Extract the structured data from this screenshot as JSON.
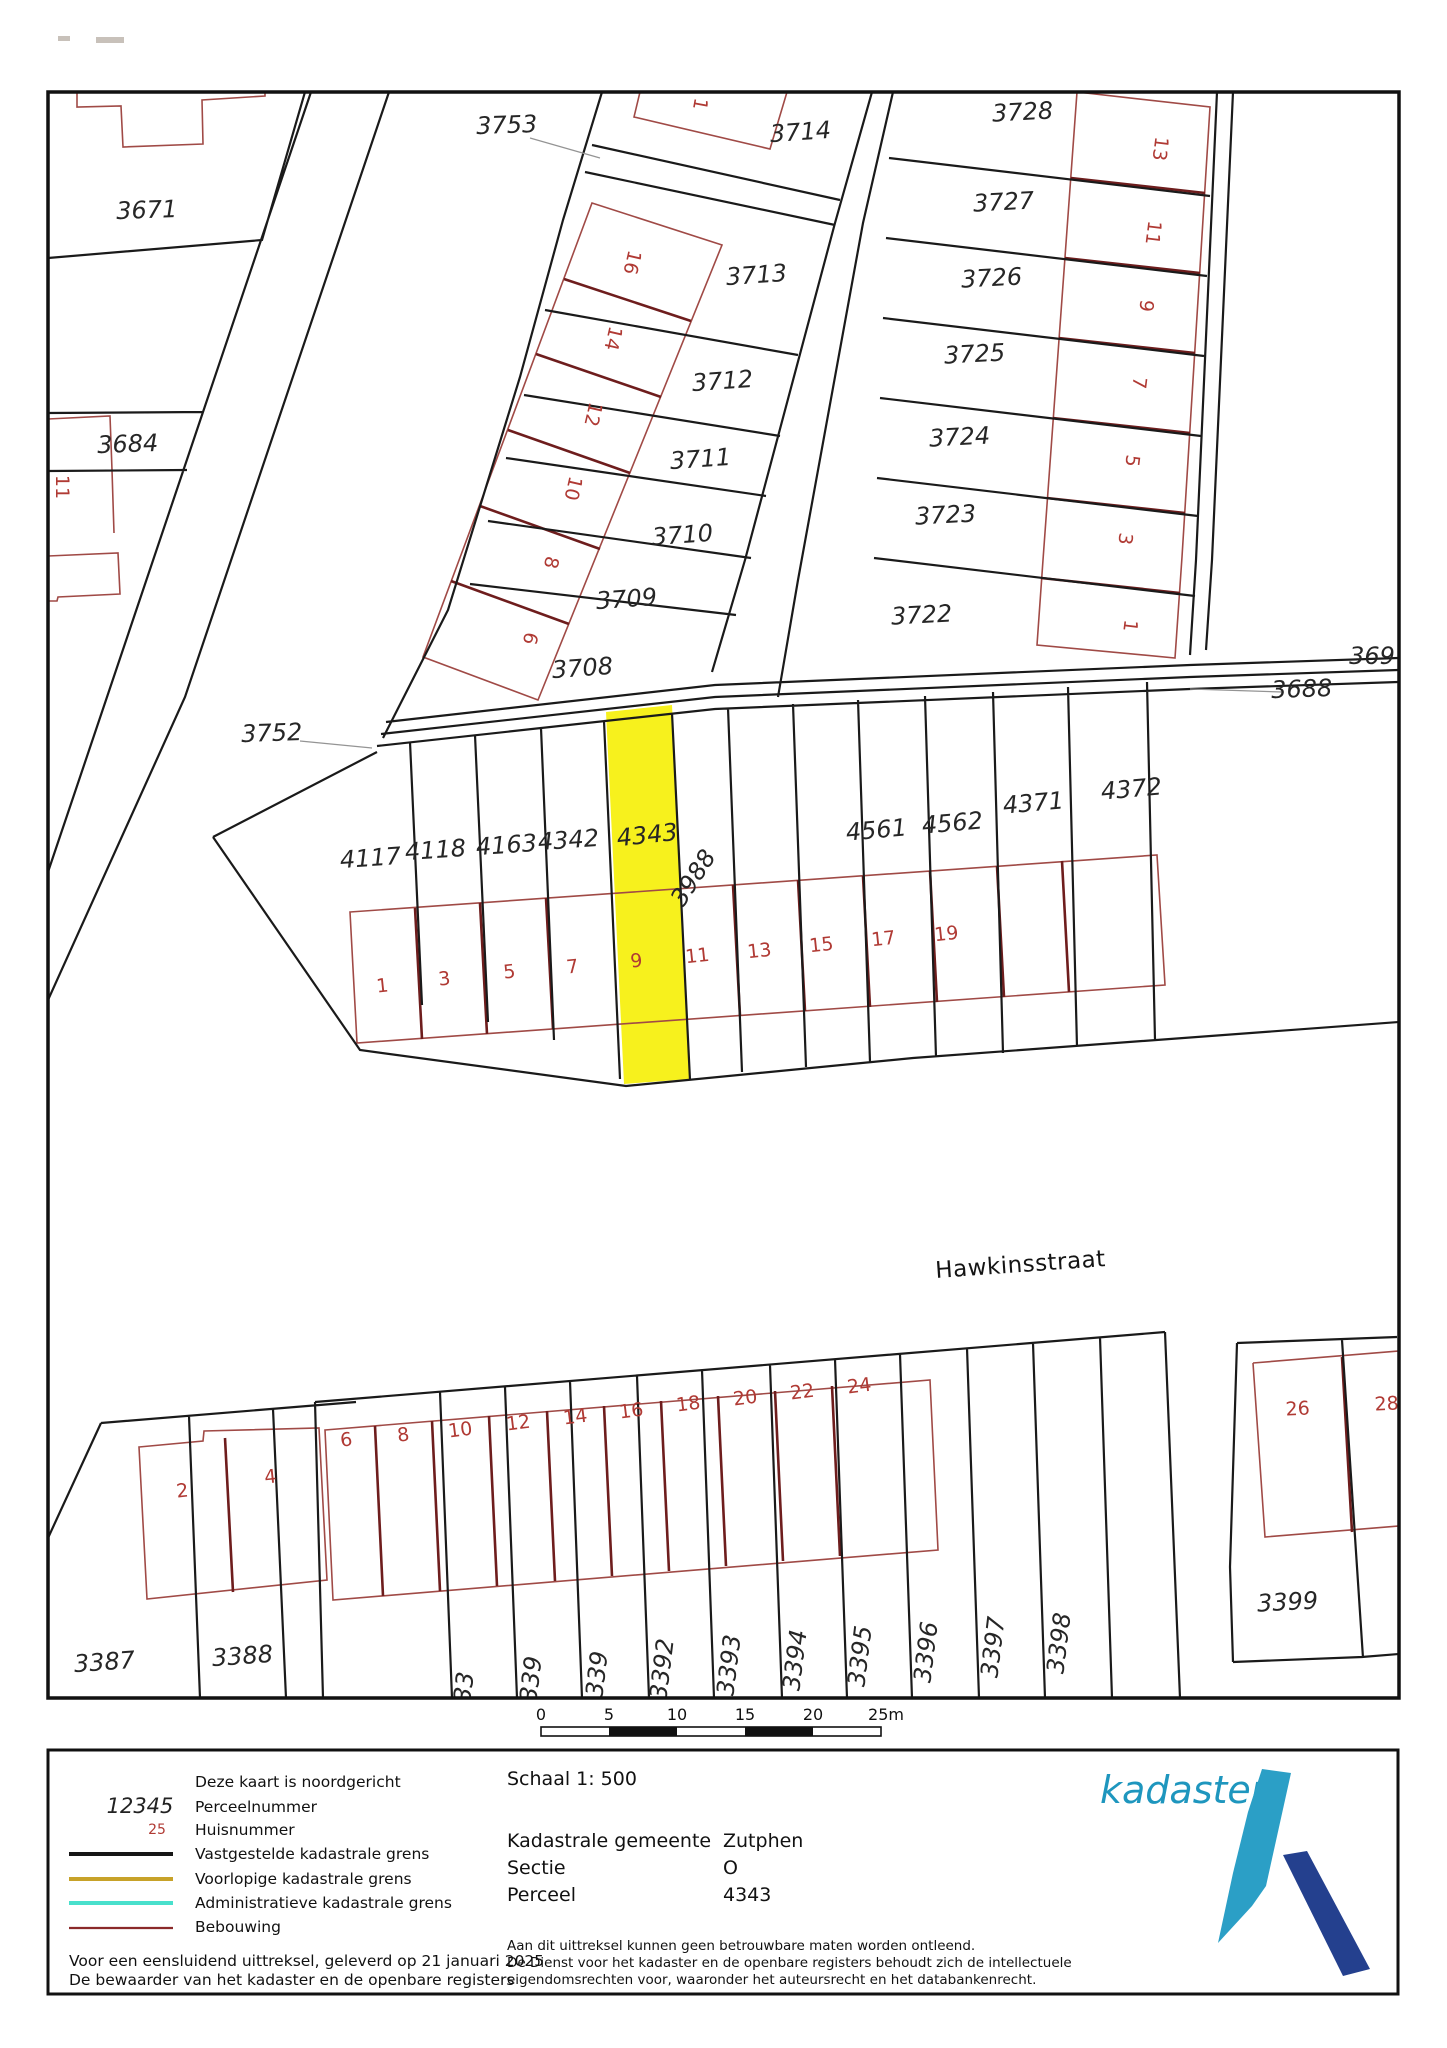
{
  "map": {
    "street_name": "Hawkinsstraat",
    "highlighted_parcel": "4343",
    "colors": {
      "highlight": "#f7f11d",
      "boundary": "#1a1a1a",
      "building": "#a04a46",
      "building_wall": "#6e1d1d",
      "house_number": "#b03a34",
      "leader": "#949494"
    },
    "parcel_labels": [
      {
        "text": "3671",
        "x": 147,
        "y": 218,
        "rot": -2
      },
      {
        "text": "3684",
        "x": 128,
        "y": 452,
        "rot": -2
      },
      {
        "text": "3753",
        "x": 507,
        "y": 133,
        "rot": -2
      },
      {
        "text": "3752",
        "x": 272,
        "y": 741,
        "rot": -2
      },
      {
        "text": "3714",
        "x": 801,
        "y": 140,
        "rot": -4
      },
      {
        "text": "3713",
        "x": 757,
        "y": 283,
        "rot": -4
      },
      {
        "text": "3712",
        "x": 723,
        "y": 389,
        "rot": -4
      },
      {
        "text": "3711",
        "x": 701,
        "y": 467,
        "rot": -4
      },
      {
        "text": "3710",
        "x": 683,
        "y": 543,
        "rot": -4
      },
      {
        "text": "3709",
        "x": 627,
        "y": 607,
        "rot": -4
      },
      {
        "text": "3708",
        "x": 583,
        "y": 676,
        "rot": -4
      },
      {
        "text": "3728",
        "x": 1023,
        "y": 120,
        "rot": -3
      },
      {
        "text": "3727",
        "x": 1004,
        "y": 210,
        "rot": -3
      },
      {
        "text": "3726",
        "x": 992,
        "y": 286,
        "rot": -3
      },
      {
        "text": "3725",
        "x": 975,
        "y": 362,
        "rot": -3
      },
      {
        "text": "3724",
        "x": 960,
        "y": 445,
        "rot": -3
      },
      {
        "text": "3723",
        "x": 946,
        "y": 523,
        "rot": -3
      },
      {
        "text": "3722",
        "x": 922,
        "y": 623,
        "rot": -3
      },
      {
        "text": "3688",
        "x": 1302,
        "y": 697,
        "rot": -2
      },
      {
        "text": "369",
        "x": 1372,
        "y": 664,
        "rot": 0
      },
      {
        "text": "4117",
        "x": 371,
        "y": 866,
        "rot": -4
      },
      {
        "text": "4118",
        "x": 436,
        "y": 858,
        "rot": -4
      },
      {
        "text": "4163",
        "x": 507,
        "y": 853,
        "rot": -4
      },
      {
        "text": "4342",
        "x": 569,
        "y": 848,
        "rot": -4
      },
      {
        "text": "4343",
        "x": 648,
        "y": 843,
        "rot": -6
      },
      {
        "text": "3988",
        "x": 700,
        "y": 882,
        "rot": -57
      },
      {
        "text": "4561",
        "x": 877,
        "y": 838,
        "rot": -5
      },
      {
        "text": "4562",
        "x": 953,
        "y": 831,
        "rot": -5
      },
      {
        "text": "4371",
        "x": 1034,
        "y": 811,
        "rot": -5
      },
      {
        "text": "4372",
        "x": 1132,
        "y": 797,
        "rot": -5
      },
      {
        "text": "3387",
        "x": 105,
        "y": 1670,
        "rot": -4
      },
      {
        "text": "3388",
        "x": 243,
        "y": 1664,
        "rot": -4
      },
      {
        "text": "3399",
        "x": 1288,
        "y": 1610,
        "rot": -3
      },
      {
        "text": "33",
        "x": 472,
        "y": 1688,
        "rot": -83
      },
      {
        "text": "339",
        "x": 539,
        "y": 1680,
        "rot": -83
      },
      {
        "text": "339",
        "x": 605,
        "y": 1675,
        "rot": -83
      },
      {
        "text": "3392",
        "x": 670,
        "y": 1670,
        "rot": -83
      },
      {
        "text": "3393",
        "x": 737,
        "y": 1666,
        "rot": -83
      },
      {
        "text": "3394",
        "x": 803,
        "y": 1661,
        "rot": -83
      },
      {
        "text": "3395",
        "x": 868,
        "y": 1657,
        "rot": -83
      },
      {
        "text": "3396",
        "x": 934,
        "y": 1653,
        "rot": -83
      },
      {
        "text": "3397",
        "x": 1001,
        "y": 1648,
        "rot": -83
      },
      {
        "text": "3398",
        "x": 1067,
        "y": 1644,
        "rot": -83
      }
    ],
    "house_numbers": [
      {
        "text": "16",
        "x": 626,
        "y": 261,
        "rot": 103
      },
      {
        "text": "14",
        "x": 607,
        "y": 337,
        "rot": 103
      },
      {
        "text": "12",
        "x": 587,
        "y": 413,
        "rot": 103
      },
      {
        "text": "10",
        "x": 567,
        "y": 487,
        "rot": 103
      },
      {
        "text": "8",
        "x": 545,
        "y": 561,
        "rot": 103
      },
      {
        "text": "6",
        "x": 524,
        "y": 637,
        "rot": 103
      },
      {
        "text": "1",
        "x": 694,
        "y": 103,
        "rot": 100
      },
      {
        "text": "13",
        "x": 1154,
        "y": 148,
        "rot": 97
      },
      {
        "text": "11",
        "x": 1147,
        "y": 232,
        "rot": 97
      },
      {
        "text": "9",
        "x": 1140,
        "y": 305,
        "rot": 97
      },
      {
        "text": "7",
        "x": 1133,
        "y": 382,
        "rot": 97
      },
      {
        "text": "5",
        "x": 1126,
        "y": 460,
        "rot": 97
      },
      {
        "text": "3",
        "x": 1119,
        "y": 538,
        "rot": 97
      },
      {
        "text": "1",
        "x": 1124,
        "y": 625,
        "rot": 97
      },
      {
        "text": "11",
        "x": 56,
        "y": 487,
        "rot": 90
      },
      {
        "text": "1",
        "x": 383,
        "y": 992,
        "rot": -6
      },
      {
        "text": "3",
        "x": 445,
        "y": 985,
        "rot": -6
      },
      {
        "text": "5",
        "x": 510,
        "y": 978,
        "rot": -6
      },
      {
        "text": "7",
        "x": 573,
        "y": 973,
        "rot": -6
      },
      {
        "text": "9",
        "x": 637,
        "y": 967,
        "rot": -6
      },
      {
        "text": "11",
        "x": 698,
        "y": 962,
        "rot": -6
      },
      {
        "text": "13",
        "x": 760,
        "y": 957,
        "rot": -6
      },
      {
        "text": "15",
        "x": 822,
        "y": 951,
        "rot": -6
      },
      {
        "text": "17",
        "x": 884,
        "y": 945,
        "rot": -6
      },
      {
        "text": "19",
        "x": 947,
        "y": 940,
        "rot": -6
      },
      {
        "text": "2",
        "x": 183,
        "y": 1497,
        "rot": -6
      },
      {
        "text": "4",
        "x": 271,
        "y": 1483,
        "rot": -6
      },
      {
        "text": "6",
        "x": 347,
        "y": 1446,
        "rot": -7
      },
      {
        "text": "8",
        "x": 404,
        "y": 1441,
        "rot": -7
      },
      {
        "text": "10",
        "x": 461,
        "y": 1436,
        "rot": -7
      },
      {
        "text": "12",
        "x": 519,
        "y": 1429,
        "rot": -7
      },
      {
        "text": "14",
        "x": 576,
        "y": 1423,
        "rot": -7
      },
      {
        "text": "16",
        "x": 632,
        "y": 1417,
        "rot": -7
      },
      {
        "text": "18",
        "x": 689,
        "y": 1410,
        "rot": -7
      },
      {
        "text": "20",
        "x": 746,
        "y": 1404,
        "rot": -7
      },
      {
        "text": "22",
        "x": 803,
        "y": 1398,
        "rot": -7
      },
      {
        "text": "24",
        "x": 860,
        "y": 1392,
        "rot": -7
      },
      {
        "text": "26",
        "x": 1298,
        "y": 1415,
        "rot": -3
      },
      {
        "text": "28",
        "x": 1387,
        "y": 1410,
        "rot": -3
      }
    ]
  },
  "scalebar": {
    "ticks": [
      "0",
      "5",
      "10",
      "15",
      "20",
      "25m"
    ]
  },
  "legend": {
    "sample_parcel_number": "12345",
    "sample_house_number": "25",
    "items": [
      {
        "label": "Deze kaart is noordgericht"
      },
      {
        "label": "Perceelnummer"
      },
      {
        "label": "Huisnummer"
      },
      {
        "label": "Vastgestelde kadastrale grens",
        "color": "#161616"
      },
      {
        "label": "Voorlopige kadastrale grens",
        "color": "#c7a229"
      },
      {
        "label": "Administratieve kadastrale grens",
        "color": "#49e0cc"
      },
      {
        "label": "Bebouwing",
        "color": "#8b2a2a"
      }
    ],
    "footer_line1": "Voor een eensluidend uittreksel, geleverd op 21 januari 2025",
    "footer_line2": "De bewaarder van het kadaster en de openbare registers"
  },
  "info": {
    "schaal_label": "Schaal 1: 500",
    "fields": [
      {
        "label": "Kadastrale gemeente",
        "value": "Zutphen"
      },
      {
        "label": "Sectie",
        "value": "O"
      },
      {
        "label": "Perceel",
        "value": "4343"
      }
    ],
    "disclaimer": [
      "Aan dit uittreksel kunnen geen betrouwbare maten worden ontleend.",
      "De Dienst voor het kadaster en de openbare registers behoudt zich de intellectuele",
      "eigendomsrechten voor, waaronder het auteursrecht en het databankenrecht."
    ]
  },
  "logo": {
    "text": "kadaster"
  }
}
